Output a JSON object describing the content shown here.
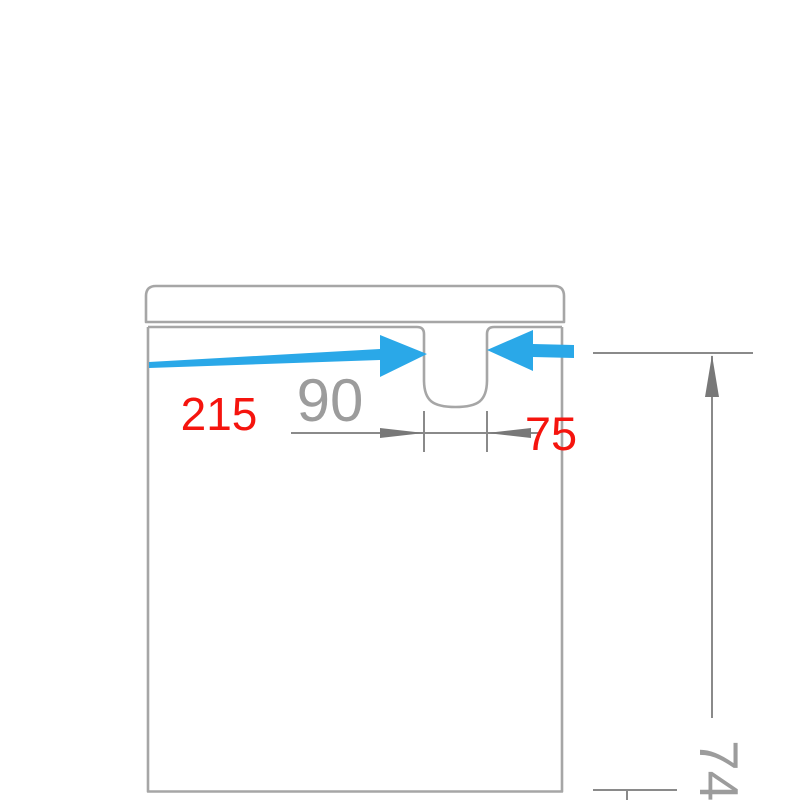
{
  "diagram": {
    "type": "technical-drawing",
    "subject": "cabinet-front-elevation-with-notch-cutout",
    "annotations": {
      "left_offset": "215",
      "notch_width": "90",
      "right_offset": "75",
      "height_partial": "74"
    },
    "colors": {
      "background": "#ffffff",
      "outline": "#a6a6a6",
      "dimension": "#8a8a8a",
      "arrowhead": "#787878",
      "dim_text": "#9c9c9c",
      "highlight_red": "#f5140e",
      "arrow_blue": "#2aa8e8"
    }
  }
}
